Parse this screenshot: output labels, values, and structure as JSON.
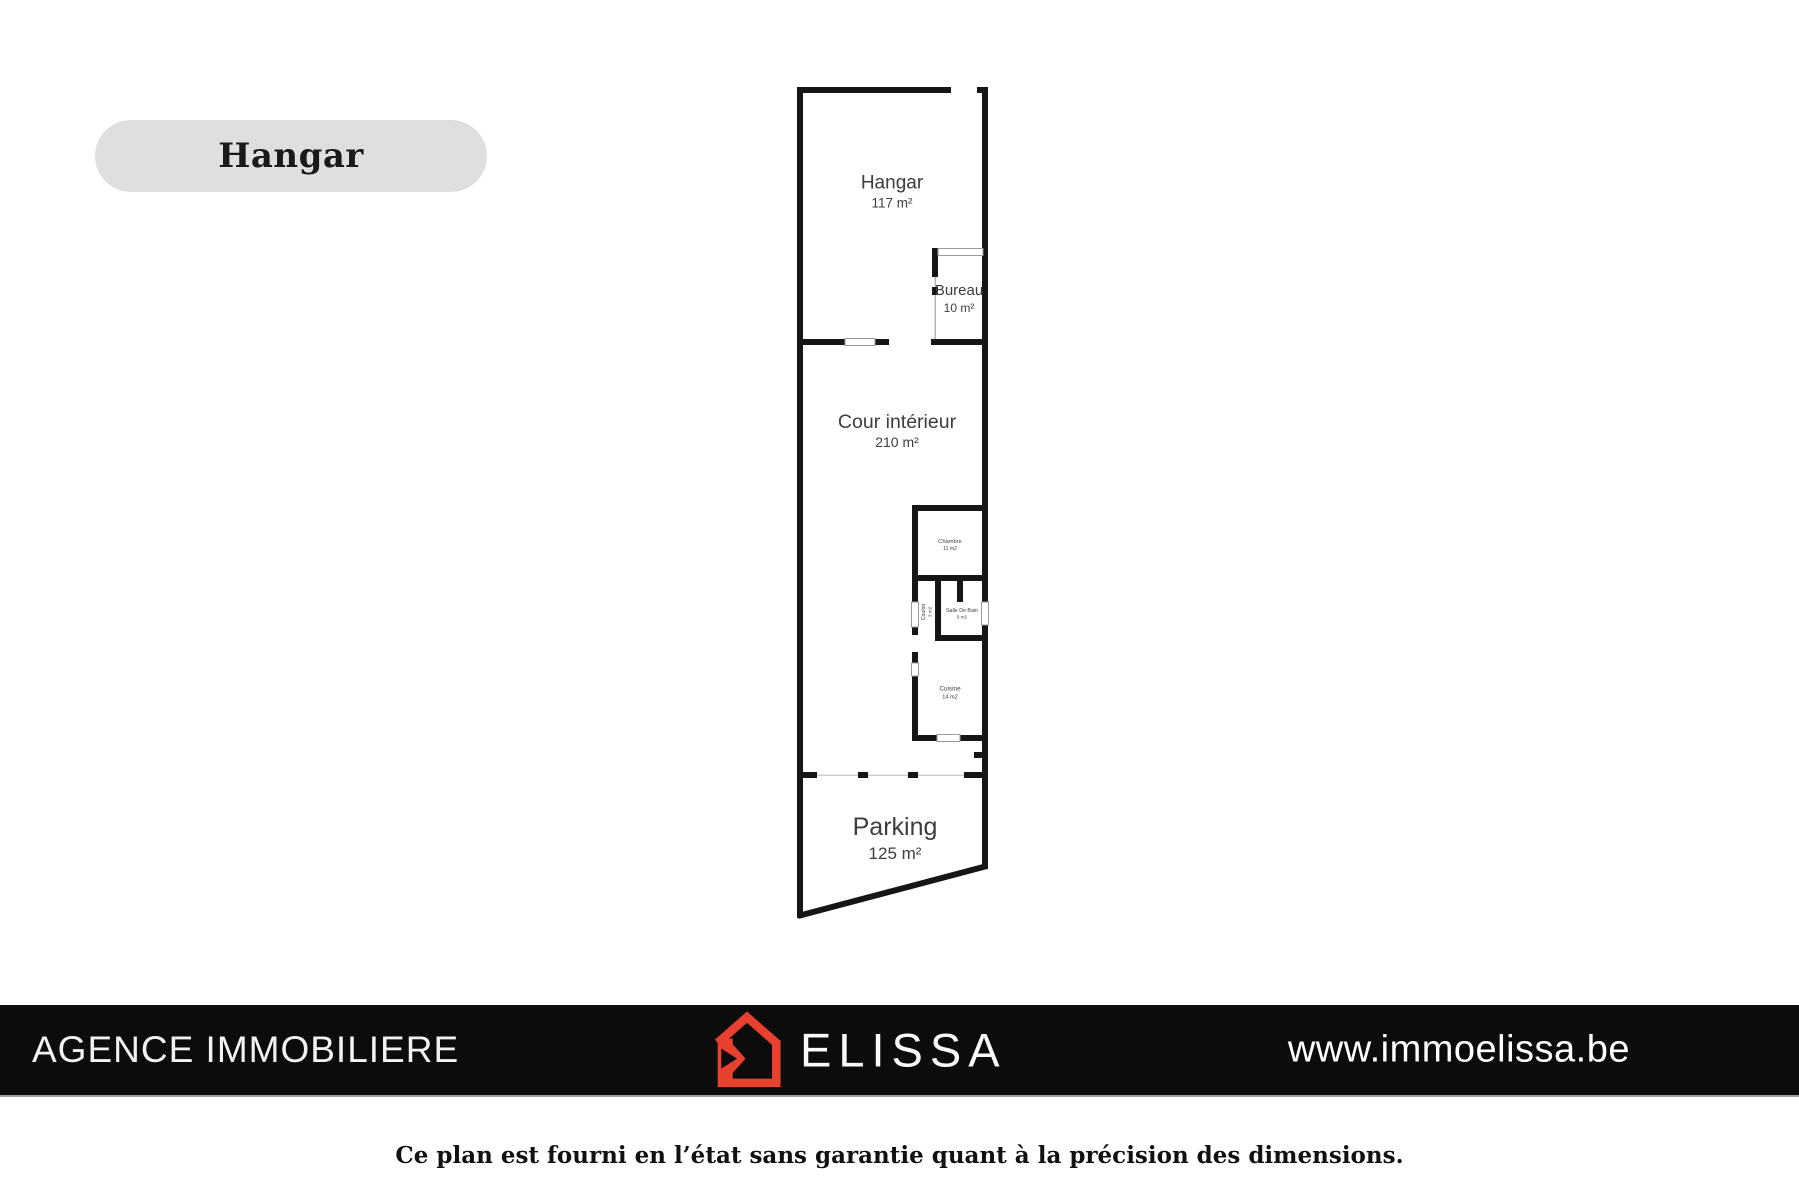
{
  "badge": {
    "label": "Hangar"
  },
  "plan": {
    "rooms": {
      "hangar": {
        "name": "Hangar",
        "area": "117 m²"
      },
      "bureau": {
        "name": "Bureau",
        "area": "10 m²"
      },
      "cour_interieur": {
        "name": "Cour intérieur",
        "area": "210 m²"
      },
      "chambre": {
        "name": "Chambre",
        "area": "11 m2"
      },
      "couloir": {
        "name": "Couloir",
        "area": "3 m2"
      },
      "salle_de_bain": {
        "name": "Salle De Bain",
        "area": "5 m2"
      },
      "cuisine": {
        "name": "Cuisine",
        "area": "14 m2"
      },
      "parking": {
        "name": "Parking",
        "area": "125 m²"
      }
    },
    "colors": {
      "wall": "#161616",
      "window_frame": "#9a9a9a",
      "label": "#3d3d3d"
    }
  },
  "banner": {
    "agency": "AGENCE IMMOBILIERE",
    "brand": "ELISSA",
    "website": "www.immoelissa.be",
    "colors": {
      "background": "#0c0c0c",
      "logo_red": "#e8402f",
      "text": "#f5f5f5"
    }
  },
  "disclaimer": "Ce plan est fourni en l’état sans garantie quant à la précision des dimensions."
}
